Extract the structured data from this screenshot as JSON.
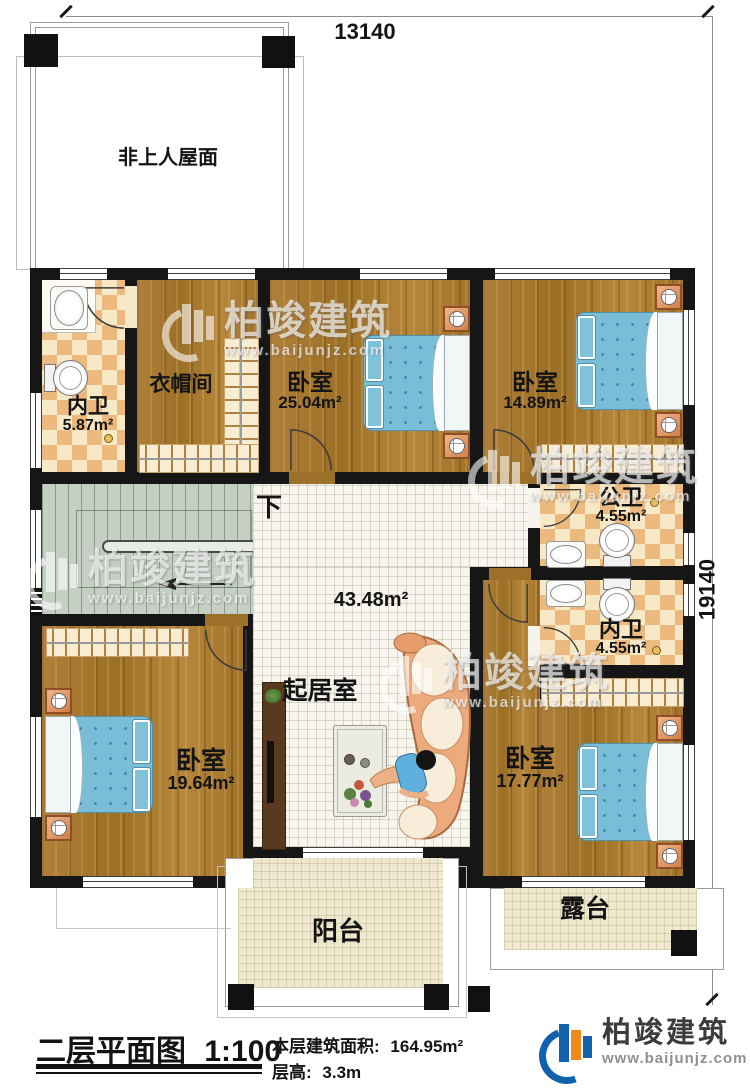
{
  "dimensions": {
    "width_label": "13140",
    "height_label": "19140"
  },
  "roof": {
    "label": "非上人屋面"
  },
  "stairs": {
    "down_label": "下"
  },
  "rooms": {
    "bath_top": {
      "name": "内卫",
      "area": "5.87m²"
    },
    "cloakroom": {
      "name": "衣帽间"
    },
    "bedroom_top_mid": {
      "name": "卧室",
      "area": "25.04m²"
    },
    "bedroom_top_right": {
      "name": "卧室",
      "area": "14.89m²"
    },
    "public_bath": {
      "name": "公卫",
      "area": "4.55m²"
    },
    "private_bath": {
      "name": "内卫",
      "area": "4.55m²"
    },
    "bedroom_left": {
      "name": "卧室",
      "area": "19.64m²"
    },
    "bedroom_right": {
      "name": "卧室",
      "area": "17.77m²"
    },
    "living": {
      "name": "起居室",
      "area": "43.48m²"
    },
    "balcony": {
      "name": "阳台"
    },
    "terrace": {
      "name": "露台"
    }
  },
  "titleblock": {
    "title": "二层平面图",
    "scale": "1:100",
    "floor_area_label": "本层建筑面积:",
    "floor_area_value": "164.95m²",
    "floor_height_label": "层高:",
    "floor_height_value": "3.3m"
  },
  "brand": {
    "name": "柏竣建筑",
    "website": "www.baijunjz.com"
  },
  "colors": {
    "wall": "#161616",
    "wood_floor": "#a8782f",
    "tile_cream": "#f7e8c6",
    "tile_accent": "#ecba7e",
    "living_floor": "#f7f5ee",
    "patio_floor": "#ede8cf",
    "stair_floor": "#c6cfc4",
    "bed_blue": "#79bdd6",
    "sofa_salmon": "#edaa7c",
    "logo_blue": "#1261ad",
    "logo_orange": "#f0881c"
  }
}
